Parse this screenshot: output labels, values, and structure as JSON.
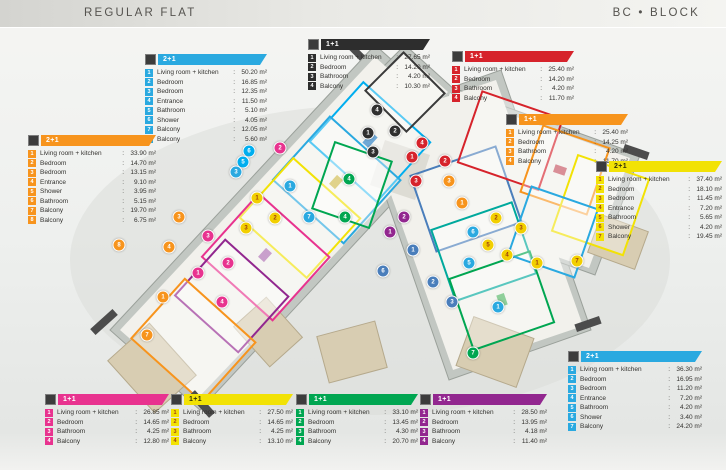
{
  "header": {
    "title": "REGULAR FLAT",
    "block": "BC • BLOCK"
  },
  "legends": [
    {
      "slot": "top-left",
      "type_label": "2+1",
      "color": "#2aa9e0",
      "dark_text": false,
      "items": [
        {
          "label": "Living room + kitchen",
          "area": "50.20 m²"
        },
        {
          "label": "Bedroom",
          "area": "16.85 m²"
        },
        {
          "label": "Bedroom",
          "area": "12.35 m²"
        },
        {
          "label": "Entrance",
          "area": "11.50 m²"
        },
        {
          "label": "Bathroom",
          "area": "5.10 m²"
        },
        {
          "label": "Shower",
          "area": "4.05 m²"
        },
        {
          "label": "Balcony",
          "area": "12.05 m²"
        },
        {
          "label": "Balcony",
          "area": "5.60 m²"
        }
      ]
    },
    {
      "slot": "top-center",
      "type_label": "1+1",
      "color": "#2d2d2d",
      "dark_text": false,
      "items": [
        {
          "label": "Living room + kitchen",
          "area": "27.65 m²"
        },
        {
          "label": "Bedroom",
          "area": "14.20 m²"
        },
        {
          "label": "Bathroom",
          "area": "4.20 m²"
        },
        {
          "label": "Balcony",
          "area": "10.30 m²"
        }
      ]
    },
    {
      "slot": "top-right",
      "type_label": "1+1",
      "color": "#d6232b",
      "dark_text": false,
      "items": [
        {
          "label": "Living room + kitchen",
          "area": "25.40 m²"
        },
        {
          "label": "Bedroom",
          "area": "14.20 m²"
        },
        {
          "label": "Bathroom",
          "area": "4.20 m²"
        },
        {
          "label": "Balcony",
          "area": "11.70 m²"
        }
      ]
    },
    {
      "slot": "right-upper",
      "type_label": "1+1",
      "color": "#f7941d",
      "dark_text": false,
      "items": [
        {
          "label": "Living room + kitchen",
          "area": "25.40 m²"
        },
        {
          "label": "Bedroom",
          "area": "14.25 m²"
        },
        {
          "label": "Bathroom",
          "area": "4.20 m²"
        },
        {
          "label": "Balcony",
          "area": "11.70 m²"
        }
      ]
    },
    {
      "slot": "right-mid",
      "type_label": "2+1",
      "color": "#f2e205",
      "dark_text": true,
      "items": [
        {
          "label": "Living room + kitchen",
          "area": "37.40 m²"
        },
        {
          "label": "Bedroom",
          "area": "18.10 m²"
        },
        {
          "label": "Bedroom",
          "area": "11.45 m²"
        },
        {
          "label": "Entrance",
          "area": "7.20 m²"
        },
        {
          "label": "Bathroom",
          "area": "5.65 m²"
        },
        {
          "label": "Shower",
          "area": "4.20 m²"
        },
        {
          "label": "Balcony",
          "area": "19.45 m²"
        }
      ]
    },
    {
      "slot": "bottom-right",
      "type_label": "2+1",
      "color": "#2aa9e0",
      "dark_text": false,
      "items": [
        {
          "label": "Living room + kitchen",
          "area": "36.30 m²"
        },
        {
          "label": "Bedroom",
          "area": "16.95 m²"
        },
        {
          "label": "Bedroom",
          "area": "11.20 m²"
        },
        {
          "label": "Entrance",
          "area": "7.20 m²"
        },
        {
          "label": "Bathroom",
          "area": "4.20 m²"
        },
        {
          "label": "Shower",
          "area": "3.40 m²"
        },
        {
          "label": "Balcony",
          "area": "24.20 m²"
        }
      ]
    },
    {
      "slot": "left",
      "type_label": "2+1",
      "color": "#f7941d",
      "dark_text": false,
      "items": [
        {
          "label": "Living room + kitchen",
          "area": "33.90 m²"
        },
        {
          "label": "Bedroom",
          "area": "14.70 m²"
        },
        {
          "label": "Bedroom",
          "area": "13.15 m²"
        },
        {
          "label": "Entrance",
          "area": "9.10 m²"
        },
        {
          "label": "Shower",
          "area": "3.95 m²"
        },
        {
          "label": "Bathroom",
          "area": "5.15 m²"
        },
        {
          "label": "Balcony",
          "area": "19.70 m²"
        },
        {
          "label": "Balcony",
          "area": "6.75 m²"
        }
      ]
    },
    {
      "slot": "bottom-1",
      "type_label": "1+1",
      "color": "#e8338f",
      "dark_text": false,
      "items": [
        {
          "label": "Living room + kitchen",
          "area": "26.85 m²"
        },
        {
          "label": "Bedroom",
          "area": "14.65 m²"
        },
        {
          "label": "Bathroom",
          "area": "4.25 m²"
        },
        {
          "label": "Balcony",
          "area": "12.80 m²"
        }
      ]
    },
    {
      "slot": "bottom-2",
      "type_label": "1+1",
      "color": "#f2e205",
      "dark_text": true,
      "items": [
        {
          "label": "Living room + kitchen",
          "area": "27.50 m²"
        },
        {
          "label": "Bedroom",
          "area": "14.65 m²"
        },
        {
          "label": "Bathroom",
          "area": "4.25 m²"
        },
        {
          "label": "Balcony",
          "area": "13.10 m²"
        }
      ]
    },
    {
      "slot": "bottom-3",
      "type_label": "1+1",
      "color": "#00a651",
      "dark_text": false,
      "items": [
        {
          "label": "Living room + kitchen",
          "area": "33.10 m²"
        },
        {
          "label": "Bedroom",
          "area": "13.45 m²"
        },
        {
          "label": "Bathroom",
          "area": "4.30 m²"
        },
        {
          "label": "Balcony",
          "area": "20.70 m²"
        }
      ]
    },
    {
      "slot": "bottom-4",
      "type_label": "1+1",
      "color": "#92278f",
      "dark_text": false,
      "items": [
        {
          "label": "Living room + kitchen",
          "area": "28.50 m²"
        },
        {
          "label": "Bedroom",
          "area": "13.95 m²"
        },
        {
          "label": "Bathroom",
          "area": "4.18 m²"
        },
        {
          "label": "Balcony",
          "area": "11.40 m²"
        }
      ]
    }
  ],
  "plan_badges": [
    {
      "n": "4",
      "color": "#2f2f2f",
      "x": 377,
      "y": 110
    },
    {
      "n": "1",
      "color": "#2f2f2f",
      "x": 368,
      "y": 133
    },
    {
      "n": "2",
      "color": "#2f2f2f",
      "x": 395,
      "y": 131
    },
    {
      "n": "3",
      "color": "#2f2f2f",
      "x": 373,
      "y": 152
    },
    {
      "n": "4",
      "color": "#d6232b",
      "x": 422,
      "y": 143
    },
    {
      "n": "1",
      "color": "#d6232b",
      "x": 412,
      "y": 157
    },
    {
      "n": "2",
      "color": "#d6232b",
      "x": 445,
      "y": 161
    },
    {
      "n": "3",
      "color": "#d6232b",
      "x": 416,
      "y": 181
    },
    {
      "n": "3",
      "color": "#f7941d",
      "x": 449,
      "y": 181
    },
    {
      "n": "1",
      "color": "#f7941d",
      "x": 462,
      "y": 203
    },
    {
      "n": "2",
      "color": "#e8338f",
      "x": 280,
      "y": 148
    },
    {
      "n": "6",
      "color": "#00aeef",
      "x": 249,
      "y": 151
    },
    {
      "n": "5",
      "color": "#00aeef",
      "x": 243,
      "y": 162
    },
    {
      "n": "3",
      "color": "#2aa9e0",
      "x": 236,
      "y": 172
    },
    {
      "n": "1",
      "color": "#2aa9e0",
      "x": 290,
      "y": 186
    },
    {
      "n": "1",
      "color": "#f2cf00",
      "x": 257,
      "y": 198
    },
    {
      "n": "2",
      "color": "#f2cf00",
      "x": 275,
      "y": 218
    },
    {
      "n": "3",
      "color": "#f2cf00",
      "x": 246,
      "y": 228
    },
    {
      "n": "3",
      "color": "#e8338f",
      "x": 208,
      "y": 236
    },
    {
      "n": "2",
      "color": "#e8338f",
      "x": 228,
      "y": 263
    },
    {
      "n": "1",
      "color": "#e8338f",
      "x": 198,
      "y": 273
    },
    {
      "n": "4",
      "color": "#e8338f",
      "x": 222,
      "y": 302
    },
    {
      "n": "3",
      "color": "#f7941d",
      "x": 179,
      "y": 217
    },
    {
      "n": "4",
      "color": "#f7941d",
      "x": 169,
      "y": 247
    },
    {
      "n": "8",
      "color": "#f7941d",
      "x": 119,
      "y": 245
    },
    {
      "n": "1",
      "color": "#f7941d",
      "x": 163,
      "y": 297
    },
    {
      "n": "7",
      "color": "#f7941d",
      "x": 147,
      "y": 335
    },
    {
      "n": "4",
      "color": "#00a651",
      "x": 349,
      "y": 179
    },
    {
      "n": "4",
      "color": "#00a651",
      "x": 345,
      "y": 217
    },
    {
      "n": "7",
      "color": "#2aa9e0",
      "x": 309,
      "y": 217
    },
    {
      "n": "2",
      "color": "#92278f",
      "x": 404,
      "y": 217
    },
    {
      "n": "1",
      "color": "#92278f",
      "x": 390,
      "y": 232
    },
    {
      "n": "1",
      "color": "#4a7ebb",
      "x": 413,
      "y": 250
    },
    {
      "n": "6",
      "color": "#4a7ebb",
      "x": 383,
      "y": 271
    },
    {
      "n": "2",
      "color": "#4a7ebb",
      "x": 433,
      "y": 282
    },
    {
      "n": "3",
      "color": "#4a7ebb",
      "x": 452,
      "y": 302
    },
    {
      "n": "1",
      "color": "#2aa9e0",
      "x": 498,
      "y": 307
    },
    {
      "n": "2",
      "color": "#f2cf00",
      "x": 496,
      "y": 218
    },
    {
      "n": "3",
      "color": "#f2cf00",
      "x": 521,
      "y": 228
    },
    {
      "n": "5",
      "color": "#f2cf00",
      "x": 488,
      "y": 245
    },
    {
      "n": "4",
      "color": "#f2cf00",
      "x": 507,
      "y": 255
    },
    {
      "n": "1",
      "color": "#f2cf00",
      "x": 537,
      "y": 263
    },
    {
      "n": "7",
      "color": "#f2cf00",
      "x": 577,
      "y": 261
    },
    {
      "n": "6",
      "color": "#2aa9e0",
      "x": 473,
      "y": 232
    },
    {
      "n": "5",
      "color": "#2aa9e0",
      "x": 469,
      "y": 263
    },
    {
      "n": "7",
      "color": "#00a651",
      "x": 473,
      "y": 353
    }
  ]
}
